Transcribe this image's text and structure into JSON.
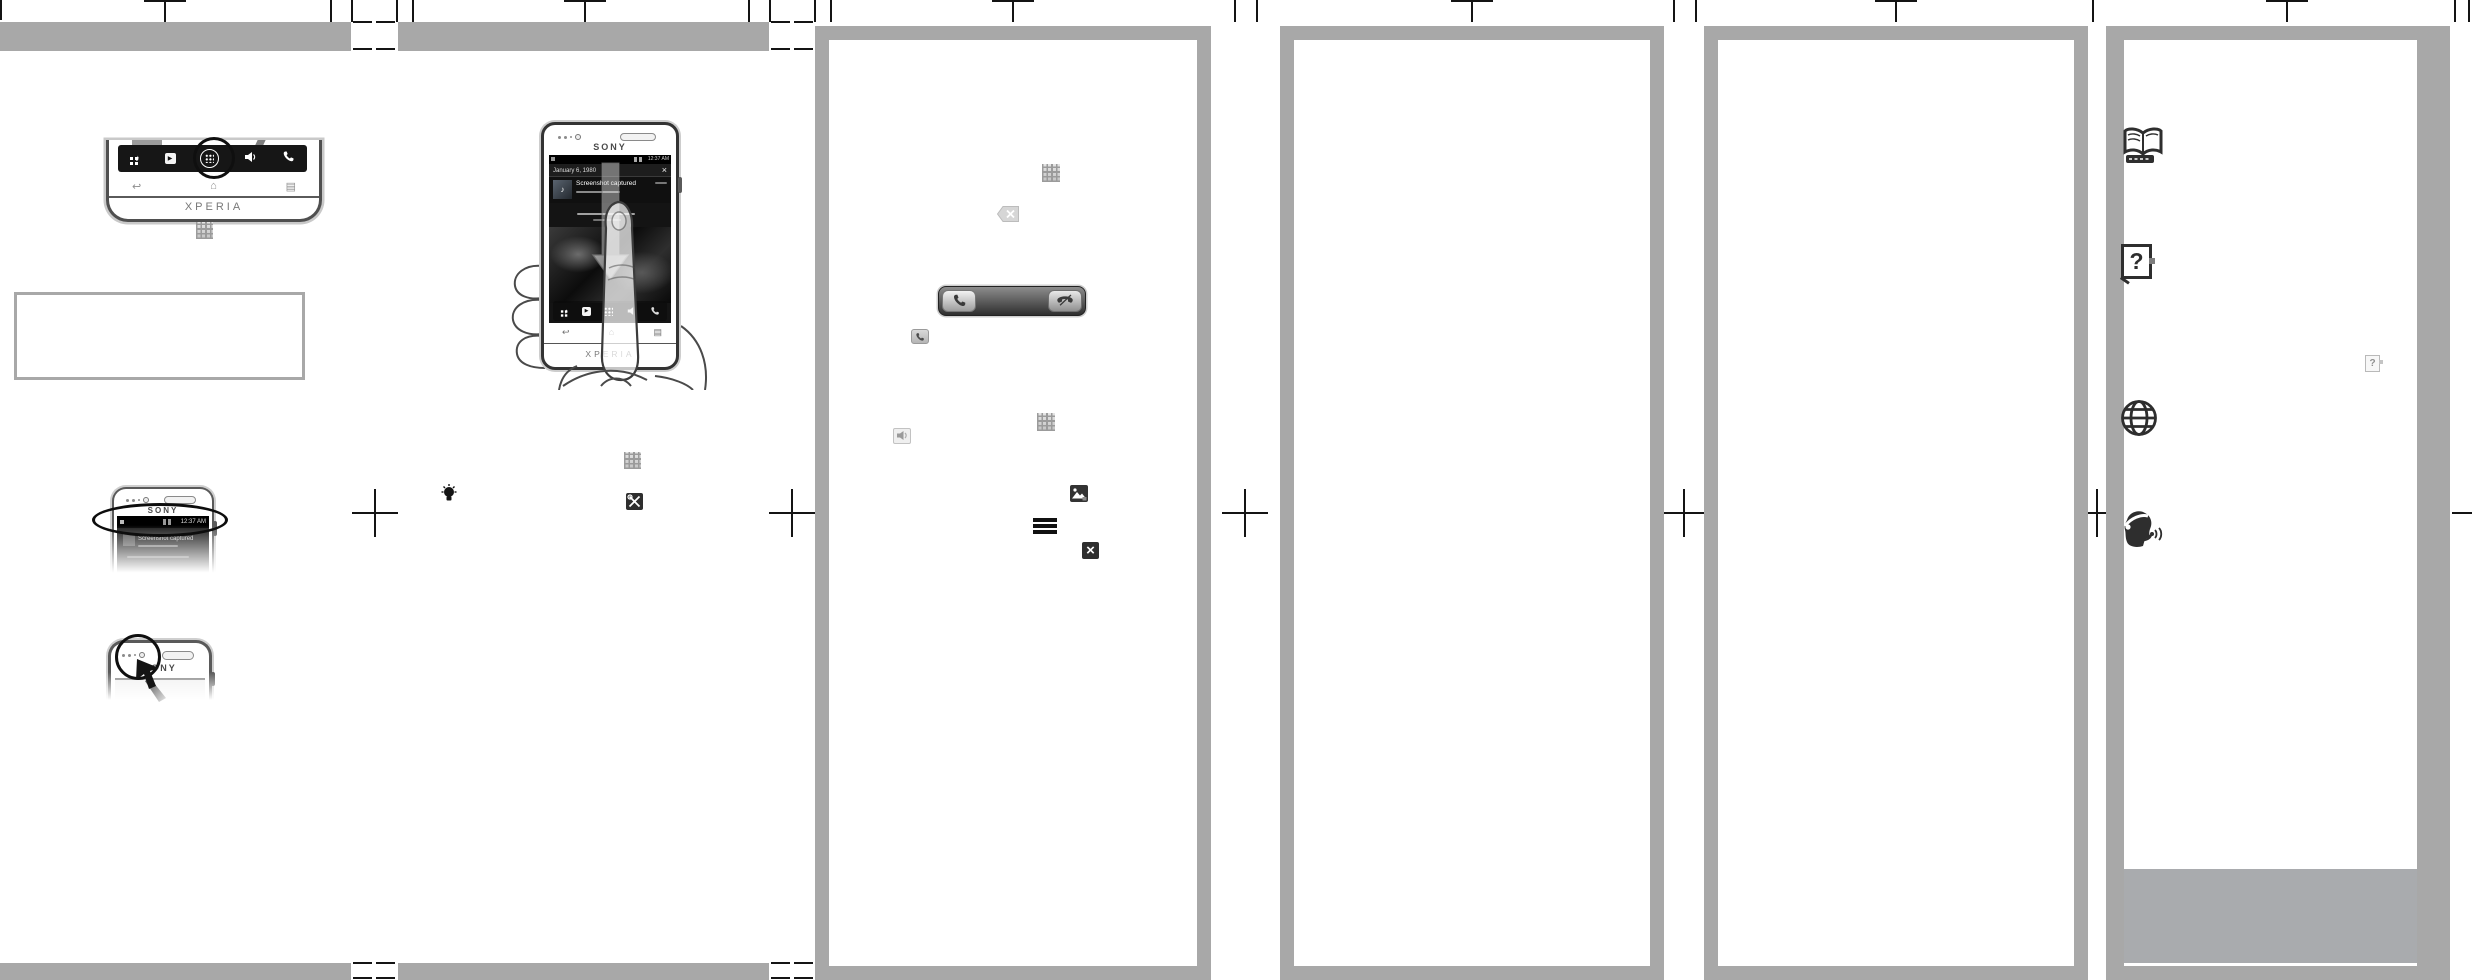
{
  "document": {
    "type": "printed quick start guide spread",
    "brand": "SONY",
    "product": "XPERIA"
  },
  "colors": {
    "bar-gray": "#a8a8a8",
    "frame-gray": "#a8a8a8",
    "block-gray": "#a9abae",
    "ink": "#333333"
  },
  "glyphs": {
    "back": "↩",
    "home": "⌂",
    "menu": "▤",
    "play": "▶",
    "note": "♪",
    "close_box": "×"
  },
  "panel1": {
    "dock_phone": {
      "chin_label": "XPERIA"
    },
    "status_phone": {
      "brand_label": "SONY",
      "status_time": "12:37 AM",
      "notification_title": "Screenshot captured"
    },
    "camera_phone": {
      "brand_label": "SONY"
    }
  },
  "panel2": {
    "hand_phone": {
      "brand_label": "SONY",
      "chin_label": "XPERIA",
      "status_time": "12:37 AM",
      "panel_date": "January 6, 1980",
      "notification_title": "Screenshot captured",
      "close_glyph": "×"
    }
  },
  "panel6": {
    "help_glyph": "?",
    "mini_help_glyph": "?"
  },
  "icons": [
    "app-grid-icon",
    "lightbulb-icon",
    "settings-tools-icon",
    "keyboard-dismiss-icon",
    "answer-call-icon",
    "reject-call-icon",
    "call-chip-icon",
    "speaker-icon",
    "gallery-icon",
    "menu-icon",
    "close-icon",
    "open-book-icon",
    "help-box-icon",
    "mini-help-icon",
    "globe-icon",
    "support-call-icon"
  ]
}
